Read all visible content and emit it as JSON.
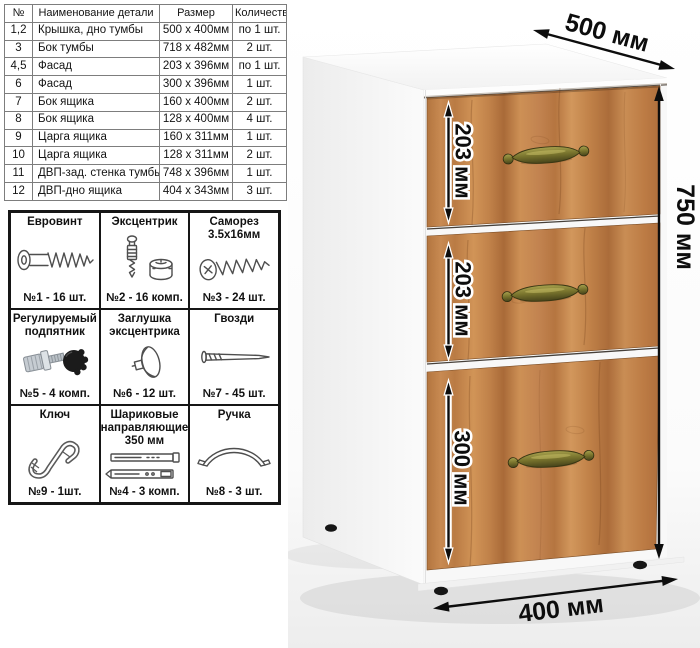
{
  "parts_table": {
    "headers": [
      "№",
      "Наименование детали",
      "Размер",
      "Количество"
    ],
    "rows": [
      [
        "1,2",
        "Крышка, дно тумбы",
        "500 х 400мм",
        "по 1 шт."
      ],
      [
        "3",
        "Бок тумбы",
        "718 х 482мм",
        "2 шт."
      ],
      [
        "4,5",
        "Фасад",
        "203 х 396мм",
        "по 1 шт."
      ],
      [
        "6",
        "Фасад",
        "300 х 396мм",
        "1 шт."
      ],
      [
        "7",
        "Бок ящика",
        "160 х 400мм",
        "2 шт."
      ],
      [
        "8",
        "Бок ящика",
        "128 х 400мм",
        "4 шт."
      ],
      [
        "9",
        "Царга ящика",
        "160 х 311мм",
        "1 шт."
      ],
      [
        "10",
        "Царга ящика",
        "128 х 311мм",
        "2 шт."
      ],
      [
        "11",
        "ДВП-зад. стенка тумбы",
        "748 х 396мм",
        "1 шт."
      ],
      [
        "12",
        "ДВП-дно ящика",
        "404 х 343мм",
        "3 шт."
      ]
    ]
  },
  "hardware": {
    "items": [
      {
        "title": "Евровинт",
        "count": "№1 - 16 шт.",
        "icon": "euro-screw-icon"
      },
      {
        "title": "Эксцентрик",
        "count": "№2 - 16 комп.",
        "icon": "cam-lock-icon"
      },
      {
        "title": "Саморез 3.5х16мм",
        "count": "№3 - 24 шт.",
        "icon": "self-tapping-screw-icon"
      },
      {
        "title": "Регулируемый подпятник",
        "count": "№5 - 4 комп.",
        "icon": "adjustable-foot-icon"
      },
      {
        "title": "Заглушка эксцентрика",
        "count": "№6 - 12 шт.",
        "icon": "cam-cover-icon"
      },
      {
        "title": "Гвозди",
        "count": "№7 - 45 шт.",
        "icon": "nails-icon"
      },
      {
        "title": "Ключ",
        "count": "№9 - 1шт.",
        "icon": "key-icon"
      },
      {
        "title": "Шариковые направляющие 350 мм",
        "count": "№4 - 3 комп.",
        "icon": "drawer-slides-icon"
      },
      {
        "title": "Ручка",
        "count": "№8 - 3 шт.",
        "icon": "handle-icon"
      }
    ]
  },
  "dimensions": {
    "top_depth": "500 мм",
    "height": "750 мм",
    "width": "400 мм",
    "drawer_top": "203 мм",
    "drawer_middle": "203 мм",
    "drawer_bottom": "300 мм"
  },
  "colors": {
    "wood": "#c28350",
    "wood_dark": "#a96a38",
    "handle_brass": "#77722c",
    "carcass_white": "#f7f7f7",
    "dimension_text": "#0d0d0d"
  }
}
